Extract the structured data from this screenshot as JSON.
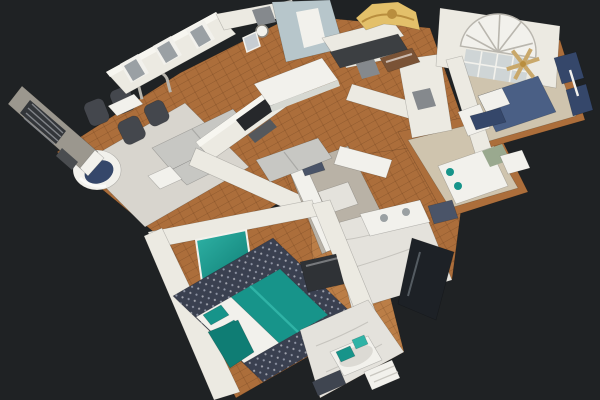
{
  "app": {
    "name": "3D home tour viewer",
    "view_mode": "dollhouse"
  },
  "scene": {
    "type": "3d-dollhouse-scan",
    "description": "Overhead dollhouse view of a scanned single-story home, tilted roughly 30 degrees, floating on a dark charcoal background",
    "rooms": [
      {
        "name": "great-room",
        "furniture": [
          "gray sectional sofa with chaise",
          "light area rug",
          "round accent chair with teal throw",
          "four dark office chairs",
          "white desk",
          "silver arched mirror",
          "fireplace wall with flat TV",
          "gray exterior wall with dark plantation-shutter window",
          "french doors with gray glass"
        ]
      },
      {
        "name": "dining-area",
        "furniture": [
          "white rectangular dining table",
          "wall clock",
          "framed art"
        ]
      },
      {
        "name": "kitchen",
        "furniture": [
          "white cabinets",
          "dark charcoal countertops",
          "wood-tone island",
          "gray tile floor",
          "small dark runner rug"
        ]
      },
      {
        "name": "foyer",
        "furniture": [
          "arched sunburst fan window over gridded entry window",
          "gold chandelier scan artifact",
          "pale blue hall walls"
        ]
      },
      {
        "name": "front-bedroom",
        "furniture": [
          "navy blue bed with white pillows",
          "navy window curtains",
          "tan ceiling-fan scan artifact",
          "white dresser"
        ]
      },
      {
        "name": "guest-bedroom",
        "furniture": [
          "white bed with sage accent",
          "white dresser",
          "navy curtain band",
          "tan carpet with wood border"
        ]
      },
      {
        "name": "hall-bathroom",
        "furniture": [
          "white vanity",
          "marble floor",
          "dark glass shower enclosure",
          "navy patterned tile"
        ]
      },
      {
        "name": "master-bedroom",
        "furniture": [
          "teal and white bed with teal pillows",
          "navy patterned area rug",
          "teal gradient wall art",
          "wood bench",
          "dark media dresser"
        ]
      },
      {
        "name": "master-bathroom",
        "furniture": [
          "soaking tub",
          "teal towels",
          "white linen shelf",
          "marble floor"
        ]
      }
    ]
  },
  "palette": {
    "background": "#1F2224",
    "wall": "#ECEAE2",
    "wallTop": "#F7F6F0",
    "wallGray": "#9B978E",
    "wallBlue": "#B7C6CB",
    "wood": "#AC6E3B",
    "woodLight": "#BB7E47",
    "trim": "#D8D6CF",
    "rug": "#D8D5CE",
    "rugNavy": "#3A4050",
    "rugNavyDot": "#8D93A3",
    "sofa": "#C7C7C3",
    "chairDark": "#44474D",
    "teal": "#17948A",
    "tealLight": "#2FB3A6",
    "tealDark": "#0F7D74",
    "navyBed": "#4A5F85",
    "navyCurtain": "#35476A",
    "gold": "#E3C06A",
    "goldDark": "#B98E3E",
    "marble": "#E4E2DC",
    "marbleVein": "#C6C4BE",
    "counterDark": "#3C3F42",
    "island": "#7A5336",
    "glassDark": "#1D2126",
    "tileNavy": "#4A5468",
    "door": "#85898D",
    "glass": "#9AA0A4",
    "white": "#F2F1EC",
    "tan": "#CFC4AE",
    "fanBlade": "#C9A86A",
    "tv": "#26282B",
    "furnDark": "#2F3236",
    "bench": "#6E4A33",
    "shutter": "#33363A",
    "mirrorFrame": "#B9B6AE"
  }
}
